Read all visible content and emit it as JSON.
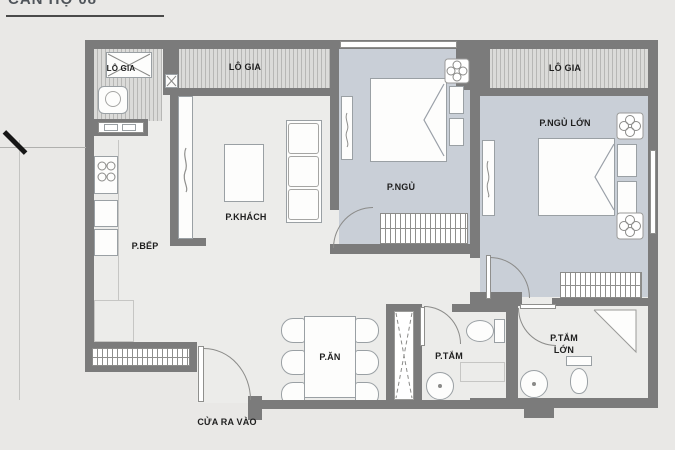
{
  "title": "CĂN HỘ 08",
  "labels": {
    "loggia_kitchen": "LÔ GIA",
    "loggia_living": "LÔ GIA",
    "loggia_master": "LÔ GIA",
    "kitchen": "P.BẾP",
    "living_room": "P.KHÁCH",
    "bedroom": "P.NGỦ",
    "master_bedroom": "P.NGỦ LỚN",
    "dining_room": "P.ĂN",
    "bathroom": "P.TẮM",
    "master_bathroom_line1": "P.TẮM",
    "master_bathroom_line2": "LỚN",
    "entrance": "CỬA RA VÀO",
    "left_dimension": "8"
  },
  "colors": {
    "wall": "#7b7b7b",
    "bedroom_floor": "#c9cfd7",
    "floor": "#ececea",
    "background": "#e9e8e6",
    "label_text": "#1e1e1e"
  }
}
